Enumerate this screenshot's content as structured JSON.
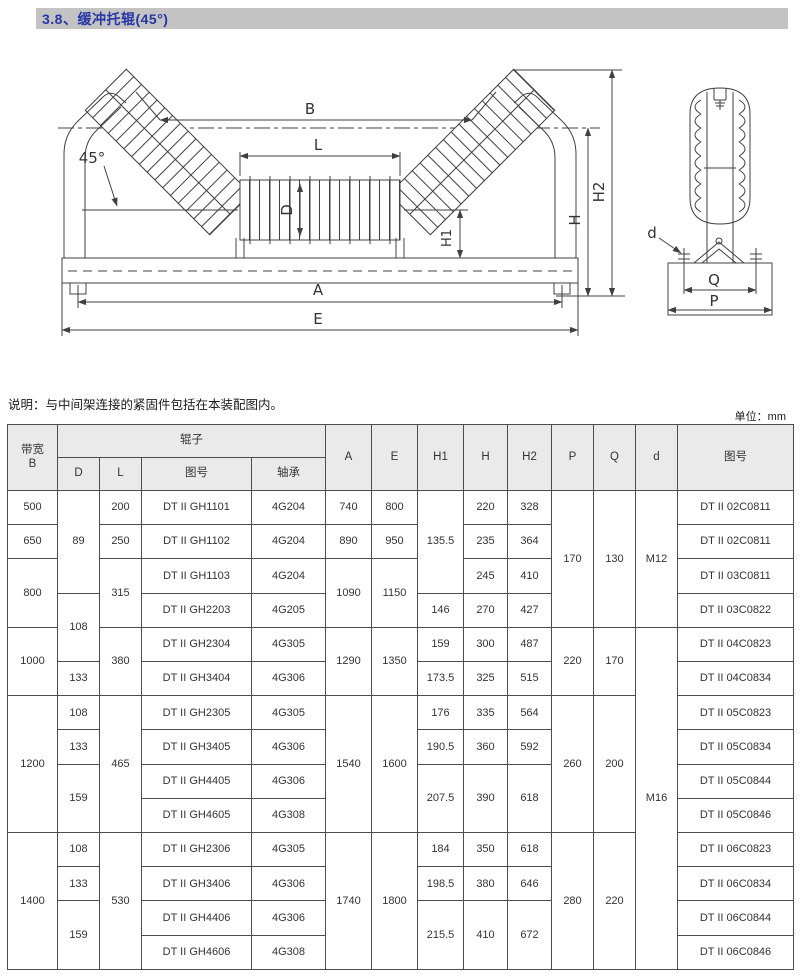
{
  "page": {
    "title": "3.8、缓冲托辊(45°)",
    "note": "说明：与中间架连接的紧固件包括在本装配图内。",
    "unit": "单位：mm"
  },
  "colors": {
    "title_text": "#2636a6",
    "title_bar_bg": "#c3c3c3",
    "table_header_bg": "#eaeaea",
    "drawing_line": "#404040"
  },
  "drawing": {
    "labels": {
      "B": "B",
      "L": "L",
      "D": "D",
      "angle": "45°",
      "H1": "H1",
      "H": "H",
      "H2": "H2",
      "A": "A",
      "E": "E",
      "Q": "Q",
      "P": "P",
      "d": "d"
    }
  },
  "table": {
    "header": {
      "bandwidth_line1": "带宽",
      "bandwidth_line2": "B",
      "roller_group": "辊子",
      "sub": [
        "D",
        "L",
        "图号",
        "轴承"
      ],
      "cols": [
        "A",
        "E",
        "H1",
        "H",
        "H2",
        "P",
        "Q",
        "d",
        "图号"
      ]
    },
    "rows": [
      [
        {
          "v": "500"
        },
        {
          "v": "89",
          "rs": 3
        },
        {
          "v": "200"
        },
        {
          "v": "DT II GH1101"
        },
        {
          "v": "4G204"
        },
        {
          "v": "740"
        },
        {
          "v": "800"
        },
        {
          "v": "135.5",
          "rs": 3
        },
        {
          "v": "220"
        },
        {
          "v": "328"
        },
        {
          "v": "170",
          "rs": 4
        },
        {
          "v": "130",
          "rs": 4
        },
        {
          "v": "M12",
          "rs": 4
        },
        {
          "v": "DT II 02C0811"
        }
      ],
      [
        {
          "v": "650"
        },
        {
          "v": "250"
        },
        {
          "v": "DT II GH1102"
        },
        {
          "v": "4G204"
        },
        {
          "v": "890"
        },
        {
          "v": "950"
        },
        {
          "v": "235"
        },
        {
          "v": "364"
        },
        {
          "v": "DT II 02C0811"
        }
      ],
      [
        {
          "v": "800",
          "rs": 2
        },
        {
          "v": "315",
          "rs": 2
        },
        {
          "v": "DT II GH1103"
        },
        {
          "v": "4G204"
        },
        {
          "v": "1090",
          "rs": 2
        },
        {
          "v": "1150",
          "rs": 2
        },
        {
          "v": "245"
        },
        {
          "v": "410"
        },
        {
          "v": "DT II 03C0811"
        }
      ],
      [
        {
          "v": "108",
          "rs": 2
        },
        {
          "v": "DT II GH2203"
        },
        {
          "v": "4G205"
        },
        {
          "v": "146"
        },
        {
          "v": "270"
        },
        {
          "v": "427"
        },
        {
          "v": "DT II 03C0822"
        }
      ],
      [
        {
          "v": "1000",
          "rs": 2
        },
        {
          "v": "380",
          "rs": 2
        },
        {
          "v": "DT II GH2304"
        },
        {
          "v": "4G305"
        },
        {
          "v": "1290",
          "rs": 2
        },
        {
          "v": "1350",
          "rs": 2
        },
        {
          "v": "159"
        },
        {
          "v": "300"
        },
        {
          "v": "487"
        },
        {
          "v": "220",
          "rs": 2
        },
        {
          "v": "170",
          "rs": 2
        },
        {
          "v": "M16",
          "rs": 10
        },
        {
          "v": "DT II 04C0823"
        }
      ],
      [
        {
          "v": "133"
        },
        {
          "v": "DT II GH3404"
        },
        {
          "v": "4G306"
        },
        {
          "v": "173.5"
        },
        {
          "v": "325"
        },
        {
          "v": "515"
        },
        {
          "v": "DT II 04C0834"
        }
      ],
      [
        {
          "v": "1200",
          "rs": 4
        },
        {
          "v": "108"
        },
        {
          "v": "465",
          "rs": 4
        },
        {
          "v": "DT II GH2305"
        },
        {
          "v": "4G305"
        },
        {
          "v": "1540",
          "rs": 4
        },
        {
          "v": "1600",
          "rs": 4
        },
        {
          "v": "176"
        },
        {
          "v": "335"
        },
        {
          "v": "564"
        },
        {
          "v": "260",
          "rs": 4
        },
        {
          "v": "200",
          "rs": 4
        },
        {
          "v": "DT II 05C0823"
        }
      ],
      [
        {
          "v": "133"
        },
        {
          "v": "DT II GH3405"
        },
        {
          "v": "4G306"
        },
        {
          "v": "190.5"
        },
        {
          "v": "360"
        },
        {
          "v": "592"
        },
        {
          "v": "DT II 05C0834"
        }
      ],
      [
        {
          "v": "159",
          "rs": 2
        },
        {
          "v": "DT II GH4405"
        },
        {
          "v": "4G306"
        },
        {
          "v": "207.5",
          "rs": 2
        },
        {
          "v": "390",
          "rs": 2
        },
        {
          "v": "618",
          "rs": 2
        },
        {
          "v": "DT II 05C0844"
        }
      ],
      [
        {
          "v": "DT II GH4605"
        },
        {
          "v": "4G308"
        },
        {
          "v": "DT II 05C0846"
        }
      ],
      [
        {
          "v": "1400",
          "rs": 4
        },
        {
          "v": "108"
        },
        {
          "v": "530",
          "rs": 4
        },
        {
          "v": "DT II GH2306"
        },
        {
          "v": "4G305"
        },
        {
          "v": "1740",
          "rs": 4
        },
        {
          "v": "1800",
          "rs": 4
        },
        {
          "v": "184"
        },
        {
          "v": "350"
        },
        {
          "v": "618"
        },
        {
          "v": "280",
          "rs": 4
        },
        {
          "v": "220",
          "rs": 4
        },
        {
          "v": "DT II 06C0823"
        }
      ],
      [
        {
          "v": "133"
        },
        {
          "v": "DT II GH3406"
        },
        {
          "v": "4G306"
        },
        {
          "v": "198.5"
        },
        {
          "v": "380"
        },
        {
          "v": "646"
        },
        {
          "v": "DT II 06C0834"
        }
      ],
      [
        {
          "v": "159",
          "rs": 2
        },
        {
          "v": "DT II GH4406"
        },
        {
          "v": "4G306"
        },
        {
          "v": "215.5",
          "rs": 2
        },
        {
          "v": "410",
          "rs": 2
        },
        {
          "v": "672",
          "rs": 2
        },
        {
          "v": "DT II 06C0844"
        }
      ],
      [
        {
          "v": "DT II GH4606"
        },
        {
          "v": "4G308"
        },
        {
          "v": "DT II 06C0846"
        }
      ]
    ]
  }
}
